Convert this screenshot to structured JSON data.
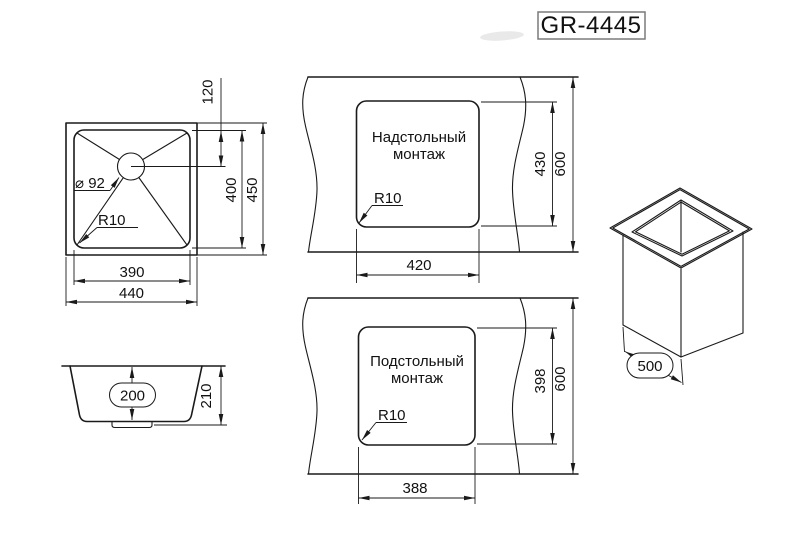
{
  "model": {
    "code": "GR-4445"
  },
  "top_view": {
    "outer_width": "440",
    "bowl_width": "390",
    "outer_depth": "450",
    "bowl_depth": "400",
    "drain_offset": "120",
    "drain_diameter": "⌀ 92",
    "corner_radius": "R10"
  },
  "side_view": {
    "bowl_height": "200",
    "overall_height": "210"
  },
  "overmount": {
    "title_line1": "Надстольный",
    "title_line2": "монтаж",
    "cutout_width": "420",
    "cutout_depth": "430",
    "counter_depth": "600",
    "corner_radius": "R10"
  },
  "undermount": {
    "title_line1": "Подстольный",
    "title_line2": "монтаж",
    "cutout_width": "388",
    "cutout_depth": "398",
    "counter_depth": "600",
    "corner_radius": "R10"
  },
  "isometric": {
    "cabinet_width": "500"
  },
  "colors": {
    "line": "#1a1a1a",
    "background": "#ffffff",
    "badge_border": "#7a7a7a"
  }
}
